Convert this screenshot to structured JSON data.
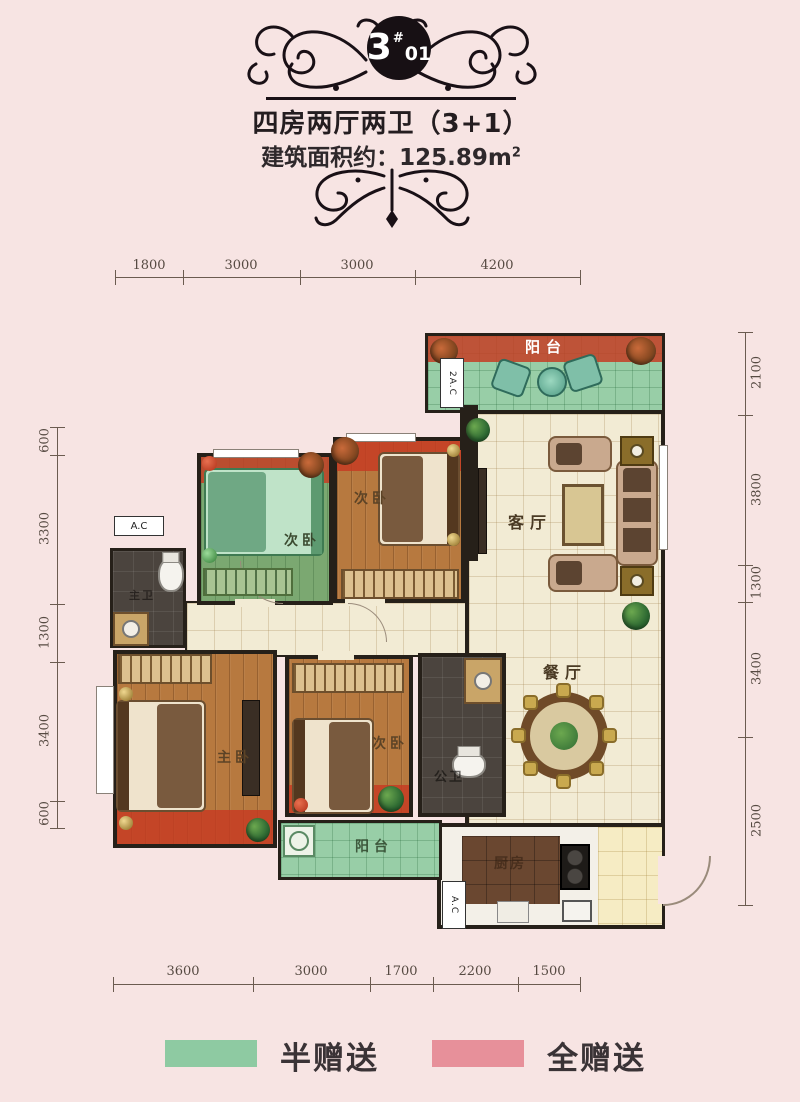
{
  "header": {
    "badge_main": "3",
    "badge_hash": "#",
    "badge_unit": "01",
    "title": "四房两厅两卫（3+1）",
    "area_text": "建筑面积约：125.89m",
    "area_sup": "2"
  },
  "dims": {
    "top": [
      "1800",
      "3000",
      "3000",
      "4200"
    ],
    "bottom": [
      "3600",
      "3000",
      "1700",
      "2200",
      "1500"
    ],
    "left": [
      "600",
      "3300",
      "1300",
      "3400",
      "600"
    ],
    "right": [
      "2100",
      "3800",
      "1300",
      "3400",
      "2500"
    ]
  },
  "rooms": {
    "balcony_top": "阳台",
    "living": "客厅",
    "dining": "餐厅",
    "bedroom_green": "次卧",
    "bedroom_top": "次卧",
    "bedroom_bottom": "次卧",
    "master": "主卧",
    "bath_master": "主卫",
    "bath_public": "公卫",
    "kitchen": "厨房",
    "balcony_bottom": "阳台",
    "ac_top": "2A.C",
    "ac_left": "A.C",
    "ac_bottom": "A.C"
  },
  "legend": {
    "half": {
      "label": "半赠送",
      "color": "#8ECAA2"
    },
    "full": {
      "label": "全赠送",
      "color": "#E7909A"
    }
  }
}
